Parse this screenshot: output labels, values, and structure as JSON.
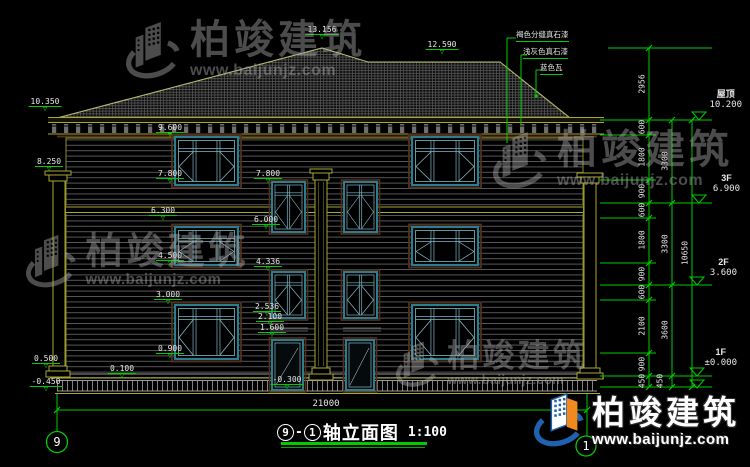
{
  "drawing_title": {
    "axis_start": "9",
    "axis_end": "1",
    "name": "轴立面图",
    "scale": "1:100"
  },
  "watermark": {
    "brand": "柏竣建筑",
    "url": "www.baijunjz.com"
  },
  "total_width": {
    "t": "21000",
    "x": 326,
    "y": 399
  },
  "axis_bubbles": [
    {
      "t": "9",
      "x": 57,
      "y": 442
    },
    {
      "t": "1",
      "x": 586,
      "y": 446
    }
  ],
  "floor_levels": [
    {
      "name": "屋顶",
      "value": "10.200",
      "x": 742,
      "y": 89
    },
    {
      "name": "3F",
      "value": "6.900",
      "x": 740,
      "y": 173
    },
    {
      "name": "2F",
      "value": "3.600",
      "x": 737,
      "y": 257
    },
    {
      "name": "1F",
      "value": "±0.000",
      "x": 737,
      "y": 347
    }
  ],
  "material_notes": [
    {
      "t": "褐色分缝真石漆",
      "x": 516,
      "y": 29
    },
    {
      "t": "浅灰色真石漆",
      "x": 523,
      "y": 46
    },
    {
      "t": "蓝色瓦",
      "x": 540,
      "y": 62
    }
  ],
  "elevation_marks": [
    {
      "t": "10.350",
      "x": 45,
      "y": 98
    },
    {
      "t": "8.250",
      "x": 49,
      "y": 158
    },
    {
      "t": "13.156",
      "x": 322,
      "y": 26
    },
    {
      "t": "12.590",
      "x": 442,
      "y": 41
    },
    {
      "t": "9.600",
      "x": 170,
      "y": 124
    },
    {
      "t": "7.800",
      "x": 170,
      "y": 170
    },
    {
      "t": "7.800",
      "x": 268,
      "y": 170
    },
    {
      "t": "6.300",
      "x": 163,
      "y": 207
    },
    {
      "t": "6.000",
      "x": 266,
      "y": 216
    },
    {
      "t": "4.500",
      "x": 170,
      "y": 252
    },
    {
      "t": "4.336",
      "x": 268,
      "y": 258
    },
    {
      "t": "3.000",
      "x": 168,
      "y": 291
    },
    {
      "t": "2.536",
      "x": 267,
      "y": 303
    },
    {
      "t": "2.100",
      "x": 270,
      "y": 313
    },
    {
      "t": "1.600",
      "x": 272,
      "y": 324
    },
    {
      "t": "0.900",
      "x": 170,
      "y": 345
    },
    {
      "t": "0.500",
      "x": 46,
      "y": 355
    },
    {
      "t": "0.100",
      "x": 122,
      "y": 365
    },
    {
      "t": "-0.450",
      "x": 46,
      "y": 378
    },
    {
      "t": "-0.300",
      "x": 287,
      "y": 376
    }
  ],
  "dim_texts": [
    {
      "t": "2956",
      "x": 642,
      "y": 84
    },
    {
      "t": "600",
      "x": 642,
      "y": 127
    },
    {
      "t": "1800",
      "x": 642,
      "y": 157
    },
    {
      "t": "900",
      "x": 642,
      "y": 191
    },
    {
      "t": "600",
      "x": 642,
      "y": 210
    },
    {
      "t": "1800",
      "x": 642,
      "y": 240
    },
    {
      "t": "900",
      "x": 642,
      "y": 274
    },
    {
      "t": "600",
      "x": 642,
      "y": 292
    },
    {
      "t": "2100",
      "x": 642,
      "y": 326
    },
    {
      "t": "900",
      "x": 642,
      "y": 364
    },
    {
      "t": "450",
      "x": 642,
      "y": 381
    },
    {
      "t": "3300",
      "x": 665,
      "y": 161
    },
    {
      "t": "3300",
      "x": 665,
      "y": 244
    },
    {
      "t": "3600",
      "x": 665,
      "y": 330
    },
    {
      "t": "450",
      "x": 660,
      "y": 381
    },
    {
      "t": "10650",
      "x": 685,
      "y": 253
    }
  ],
  "colors": {
    "dimension_green": "#00cc00",
    "frame_teal": "#2e7d8f",
    "outline_olive": "#a8a833",
    "logo_blue": "#1e62b0",
    "logo_orange": "#f08a1d"
  }
}
